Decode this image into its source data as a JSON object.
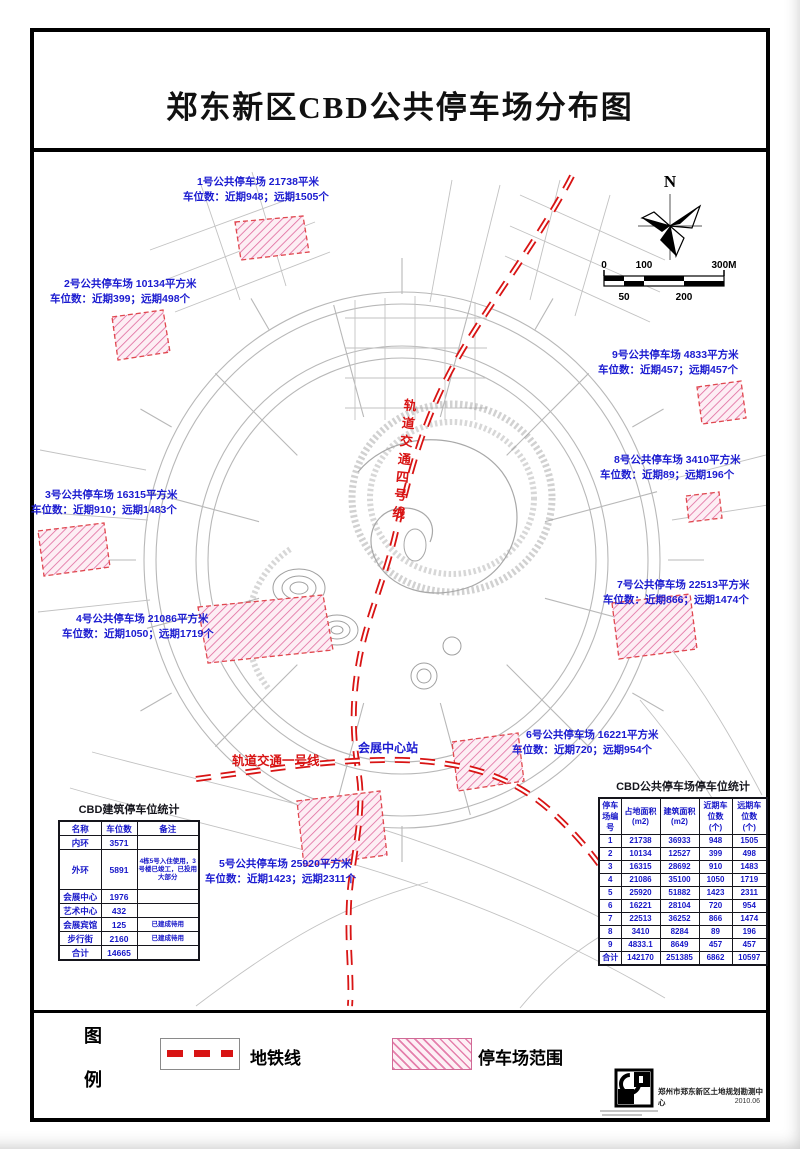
{
  "title": "郑东新区CBD公共停车场分布图",
  "compass": {
    "north": "N"
  },
  "scalebar": {
    "ticks_top": [
      "0",
      "100",
      "300M"
    ],
    "ticks_bottom": [
      "50",
      "200"
    ]
  },
  "metro": {
    "line4_label": "轨道交通四号线",
    "line1_label": "轨道交通一号线",
    "station_label": "会展中心站"
  },
  "parking_labels": [
    {
      "name": "1号公共停车场 21738平米",
      "spots": "车位数：近期948；远期1505个"
    },
    {
      "name": "2号公共停车场 10134平方米",
      "spots": "车位数：近期399；远期498个"
    },
    {
      "name": "3号公共停车场 16315平方米",
      "spots": "车位数：近期910；远期1483个"
    },
    {
      "name": "4号公共停车场 21086平方米",
      "spots": "车位数：近期1050；远期1719个"
    },
    {
      "name": "5号公共停车场 25920平方米",
      "spots": "车位数：近期1423；远期2311个"
    },
    {
      "name": "6号公共停车场 16221平方米",
      "spots": "车位数：近期720；远期954个"
    },
    {
      "name": "7号公共停车场 22513平方米",
      "spots": "车位数：近期866；远期1474个"
    },
    {
      "name": "8号公共停车场 3410平方米",
      "spots": "车位数：近期89；远期196个"
    },
    {
      "name": "9号公共停车场 4833平方米",
      "spots": "车位数：近期457；远期457个"
    }
  ],
  "building_table": {
    "title": "CBD建筑停车位统计",
    "headers": [
      "名称",
      "车位数",
      "备注"
    ],
    "rows": [
      [
        "内环",
        "3571",
        ""
      ],
      [
        "外环",
        "5891",
        "4栋5号入住使用，3号楼已竣工，已投用大部分"
      ],
      [
        "会展中心",
        "1976",
        ""
      ],
      [
        "艺术中心",
        "432",
        ""
      ],
      [
        "会展宾馆",
        "125",
        "已建成待用"
      ],
      [
        "步行街",
        "2160",
        "已建成待用"
      ],
      [
        "合计",
        "14665",
        ""
      ]
    ]
  },
  "parking_table": {
    "title": "CBD公共停车场停车位统计",
    "headers": [
      "停车场编号",
      "占地面积 (m2)",
      "建筑面积 (m2)",
      "近期车位数 (个)",
      "远期车位数 (个)"
    ],
    "rows": [
      [
        "1",
        "21738",
        "36933",
        "948",
        "1505"
      ],
      [
        "2",
        "10134",
        "12527",
        "399",
        "498"
      ],
      [
        "3",
        "16315",
        "28692",
        "910",
        "1483"
      ],
      [
        "4",
        "21086",
        "35100",
        "1050",
        "1719"
      ],
      [
        "5",
        "25920",
        "51882",
        "1423",
        "2311"
      ],
      [
        "6",
        "16221",
        "28104",
        "720",
        "954"
      ],
      [
        "7",
        "22513",
        "36252",
        "866",
        "1474"
      ],
      [
        "8",
        "3410",
        "8284",
        "89",
        "196"
      ],
      [
        "9",
        "4833.1",
        "8649",
        "457",
        "457"
      ],
      [
        "合计",
        "142170",
        "251385",
        "6862",
        "10597"
      ]
    ]
  },
  "legend": {
    "char1": "图",
    "char2": "例",
    "metro_label": "地铁线",
    "parking_label": "停车场范围"
  },
  "footer": {
    "org": "郑州市郑东新区土地规划勘测中心",
    "date": "2010.06"
  },
  "colors": {
    "label_blue": "#1b1bd0",
    "metro_red": "#d81414",
    "hatch_pink": "#e06a9e",
    "road_gray": "#b8b8b8"
  }
}
